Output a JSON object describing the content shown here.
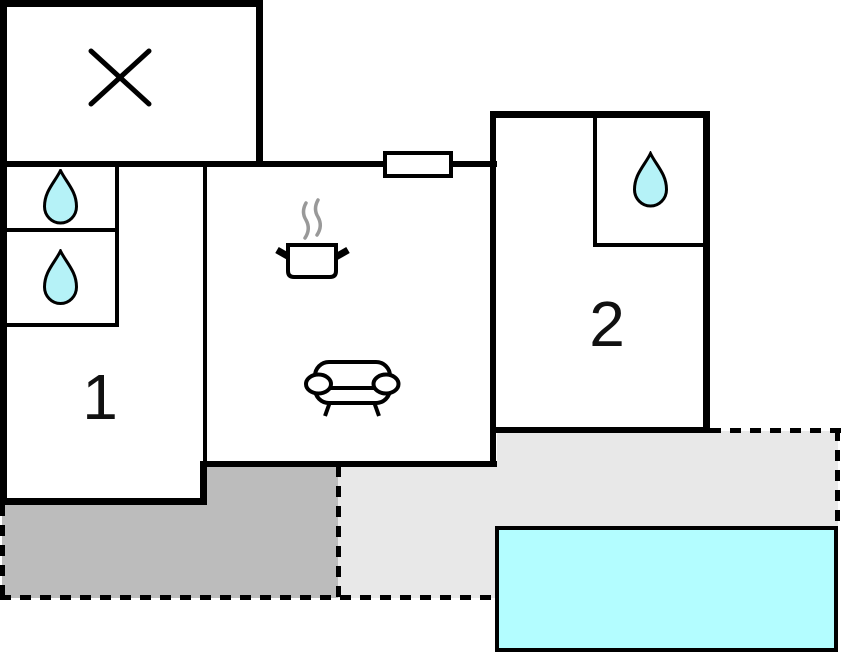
{
  "title": "Apartment floor plan with terraces and pool",
  "rooms": {
    "room1": {
      "label": "1",
      "icons": [
        "water-drop-icon",
        "water-drop-icon"
      ]
    },
    "room2": {
      "label": "2",
      "icons": [
        "water-drop-icon"
      ]
    },
    "kitchen_living": {
      "icons": [
        "cooking-pot-icon",
        "steam-icon",
        "sofa-icon"
      ],
      "window": true
    },
    "crossed_room": {
      "icons": [
        "x-mark-icon"
      ]
    }
  },
  "outdoor": {
    "terrace_dark": {
      "style": "dark-gray, dashed boundary"
    },
    "terrace_light": {
      "style": "light-gray, dashed boundary"
    },
    "pool": {
      "icon": "swimming-pool",
      "color": "#b3fdff"
    }
  },
  "colors": {
    "wall": "#000000",
    "terraceDark": "#bcbcbc",
    "terraceLight": "#e8e8e8",
    "water": "#b5f2f7",
    "pool": "#b3fdff",
    "steam": "#999999"
  }
}
